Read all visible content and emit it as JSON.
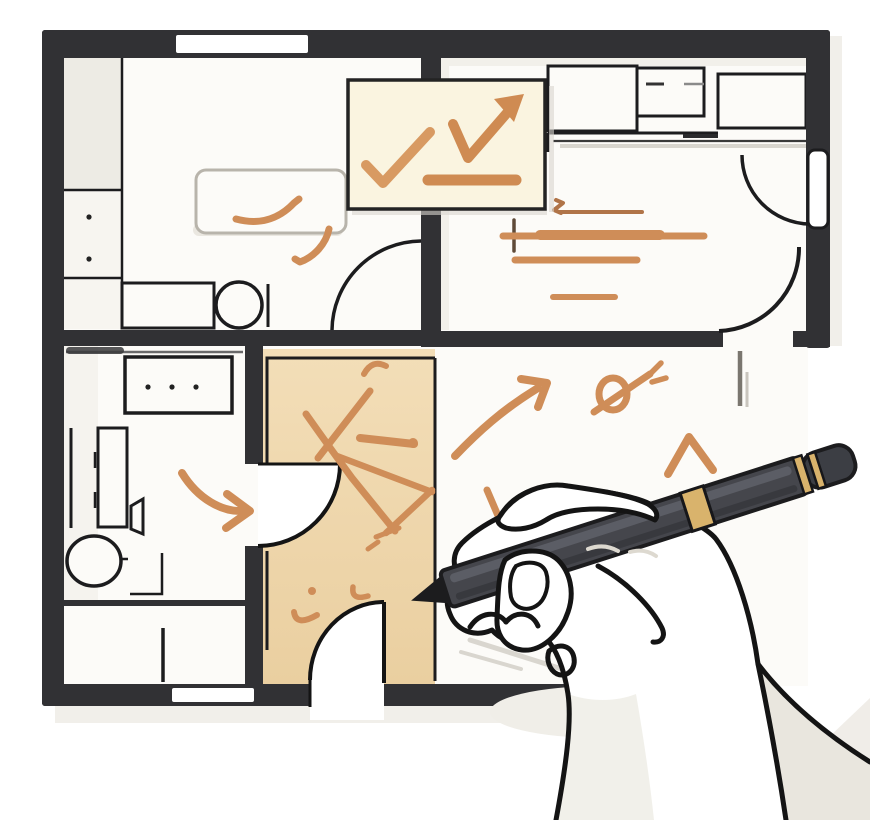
{
  "scene": {
    "title": "hand-annotating-floor-plan-illustration",
    "floor_plan": {
      "rooms": [
        "room-top-left-kitchen",
        "room-top-right-bedroom",
        "room-bottom-left-bathroom",
        "room-bottom-closet",
        "hallway",
        "living-area"
      ],
      "features": [
        "thick-outer-walls",
        "door-swing-arcs",
        "window-gaps",
        "furniture-outlines",
        "entry-arch"
      ]
    },
    "annotations": {
      "note_marks": [
        "check-mark",
        "rising-arrow-check",
        "underline-stroke"
      ],
      "plan_marks": [
        "kitchen-squiggle",
        "kitchen-comma-stroke",
        "bedroom-line-strokes",
        "hallway-x-scribble",
        "hallway-triangle-scribble",
        "hallway-small-ticks",
        "bathroom-curved-arrow",
        "living-curved-arrow",
        "spiral-doodle",
        "caret-mark"
      ]
    },
    "tools": [
      "stylus-pen",
      "drawing-hand"
    ]
  },
  "colors": {
    "wall": "#313134",
    "line": "#1c1c1e",
    "floor": "#fcfbf8",
    "floor_tint": "#f2f0ea",
    "counter_tint": "#edebe4",
    "hallway_top": "#f3deb8",
    "hallway_bottom": "#eacfa0",
    "note_bg": "#faf4e0",
    "orange": "#cf8d58",
    "orange_deep": "#c07f4a",
    "orange_thin": "#b07448",
    "cross_dark": "#5f4a38",
    "table_stroke": "#b8b4ab",
    "pen_body": "#45464c",
    "pen_facet": "#5d5f66",
    "pen_dark": "#1c1c1e",
    "pen_cap": "#3c3e44",
    "gold": "#d9b36c",
    "hand": "#ffffff",
    "hand_shade": "#e9e6de",
    "shadow": "#efede8",
    "soft_gray": "#d9d6cf",
    "outline": "#141414"
  }
}
